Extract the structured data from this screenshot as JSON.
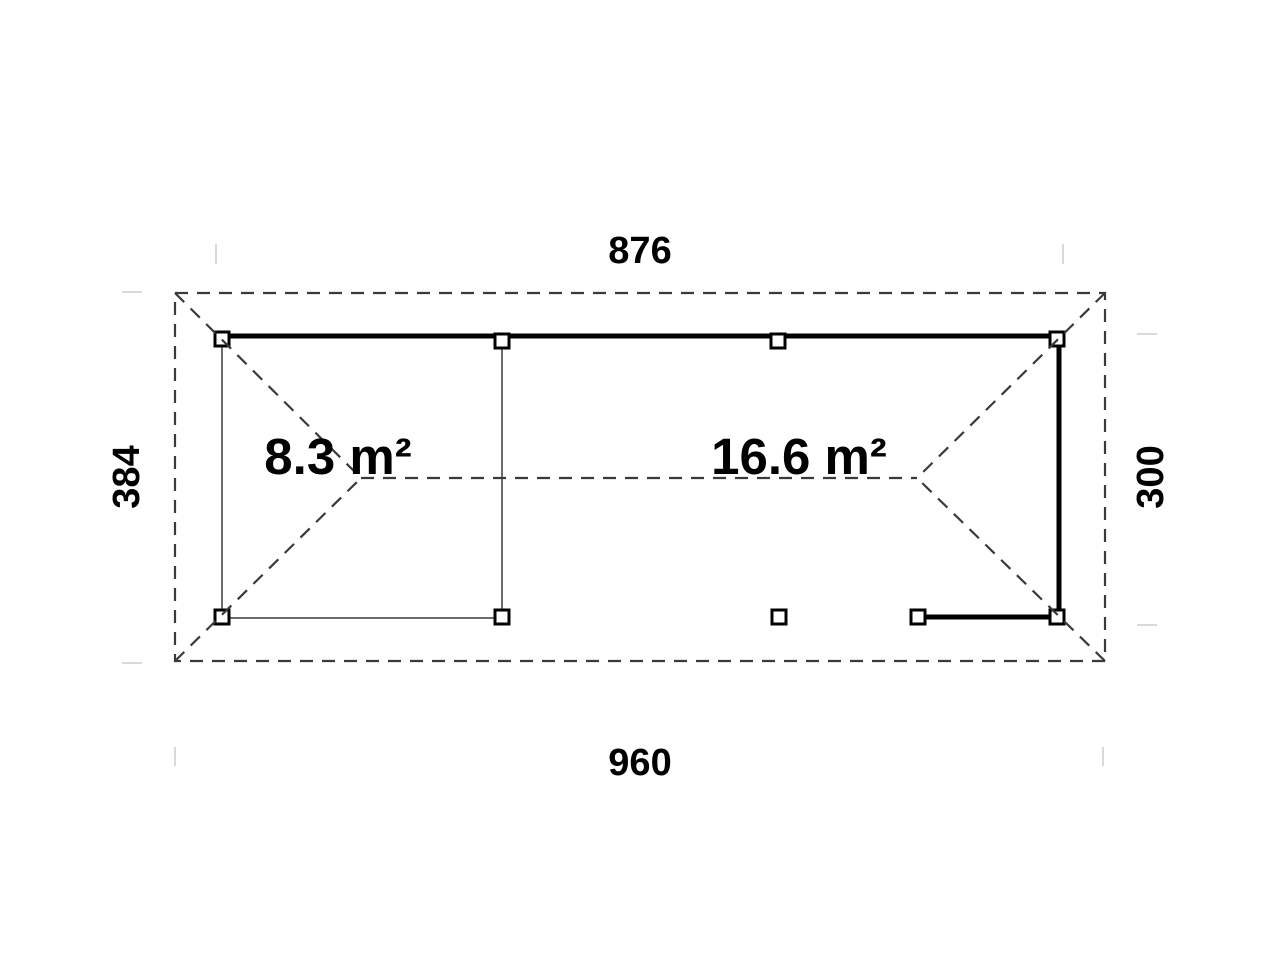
{
  "drawing": {
    "title": "garden-room-floor-plan",
    "dimensions": {
      "top_width": "876",
      "bottom_width": "960",
      "left_depth": "384",
      "right_depth": "300"
    },
    "areas": {
      "small_room": "8.3 m²",
      "large_room": "16.6 m²"
    },
    "colors": {
      "wall_line": "#000000",
      "roof_dash_line": "#3a3a3a",
      "frame_thin_line": "#3c3c3c",
      "extension_tick": "#d9d9d9",
      "label_text": "#000000",
      "background": "#ffffff"
    }
  }
}
